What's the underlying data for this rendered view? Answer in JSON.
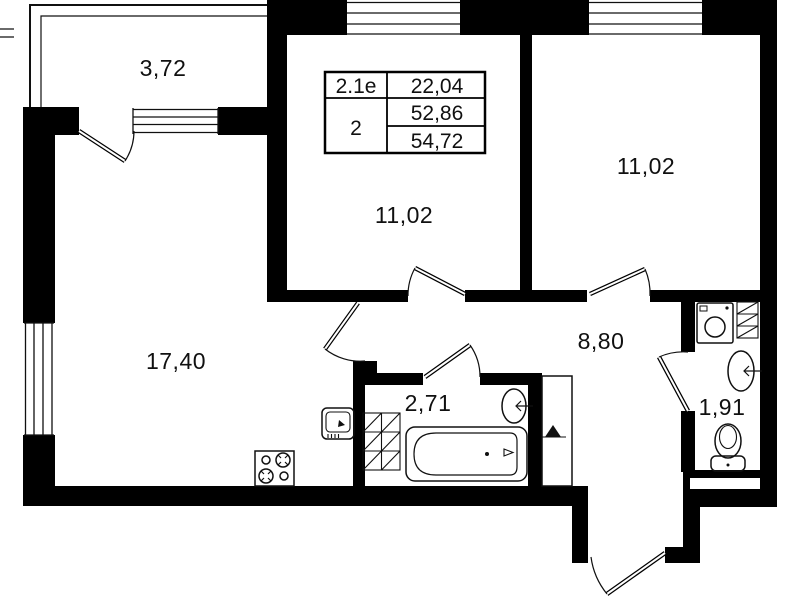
{
  "canvas": {
    "width": 799,
    "height": 600,
    "bg": "#ffffff",
    "wall_color": "#000000",
    "ink": "#101010"
  },
  "rooms": {
    "balcony": {
      "area": "3,72"
    },
    "room_top_center": {
      "area": "11,02"
    },
    "room_top_right": {
      "area": "11,02"
    },
    "living_room": {
      "area": "17,40"
    },
    "hallway": {
      "area": "8,80"
    },
    "bathroom": {
      "area": "2,71"
    },
    "wc": {
      "area": "1,91"
    }
  },
  "area_table": {
    "unit_type": "2.1е",
    "rooms_count": "2",
    "living_area": "22,04",
    "apartment_area": "52,86",
    "total_area": "54,72"
  },
  "icons": {
    "stove": "4-burner cooktop glyph",
    "kitchen_sink": "kitchen sink glyph",
    "bathtub": "bathtub glyph",
    "wash_basin": "oval wash basin glyph",
    "toilet": "toilet glyph",
    "washing_machine": "washing machine glyph",
    "vent_hatch": "hatched ventilation shaft",
    "duct_marker": "duct triangle marker",
    "window": "window glazing lines",
    "door": "door swing arc"
  }
}
